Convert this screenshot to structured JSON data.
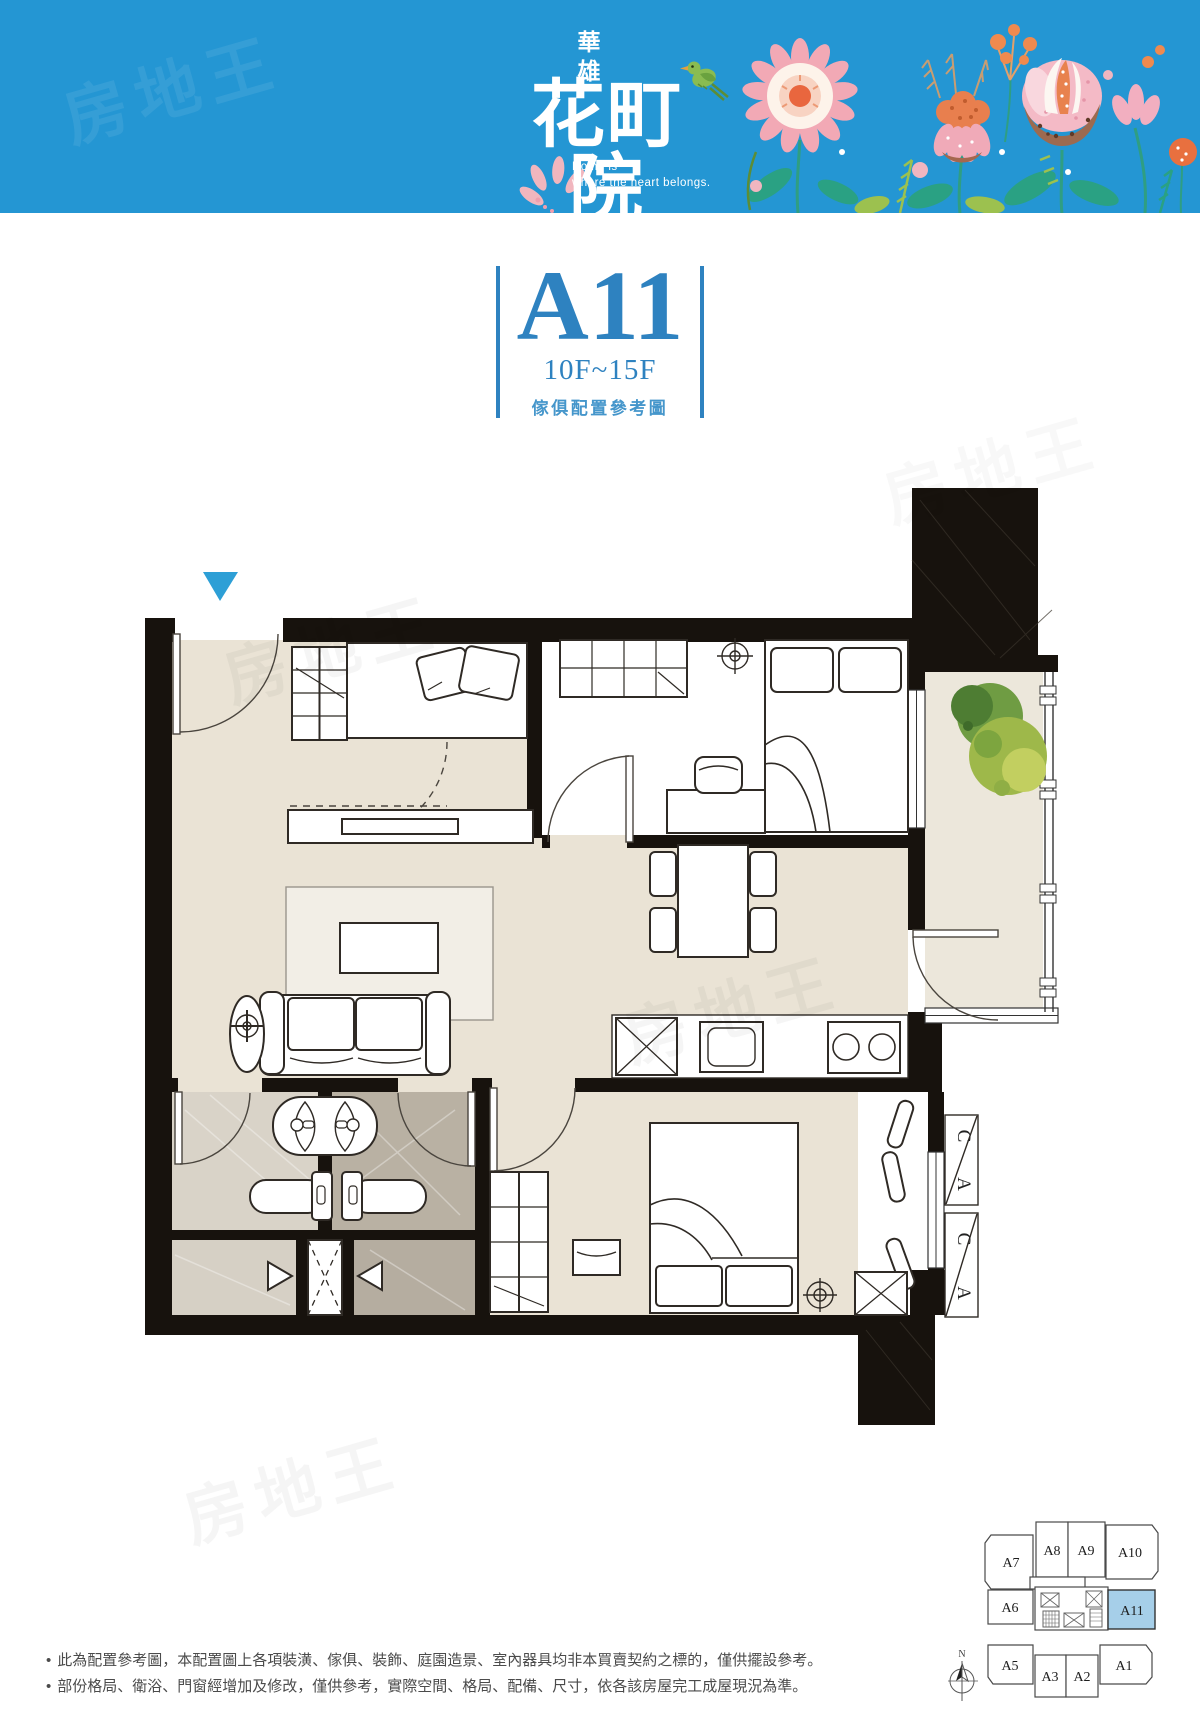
{
  "watermark": {
    "text": "房地王"
  },
  "header": {
    "brand": "華雄",
    "title": "花町院",
    "tagline1": "Home is",
    "tagline2": "where the heart belongs.",
    "background_color": "#2496d3"
  },
  "unit": {
    "code": "A11",
    "floors": "10F~15F",
    "caption": "傢俱配置參考圖",
    "accent_color": "#2e82c0"
  },
  "floor_plan": {
    "ac": [
      "A",
      "C"
    ],
    "entry_marker_color": "#2d9fd6",
    "wall_color": "#17120d",
    "floor_color": "#eae3d5",
    "bath_color": "#b9b1a3"
  },
  "key_plan": {
    "units": [
      "A7",
      "A8",
      "A9",
      "A10",
      "A6",
      "A11",
      "A5",
      "A3",
      "A2",
      "A1"
    ],
    "highlighted_unit": "A11",
    "highlight_color": "#a6cfe9",
    "compass": "N"
  },
  "disclaimer": {
    "bullet": "•",
    "line1": "此為配置參考圖，本配置圖上各項裝潢、傢俱、裝飾、庭園造景、室內器具均非本買賣契約之標的，僅供擺設參考。",
    "line2": "部份格局、衛浴、門窗經增加及修改，僅供參考，實際空間、格局、配備、尺寸，依各該房屋完工成屋現況為準。"
  }
}
